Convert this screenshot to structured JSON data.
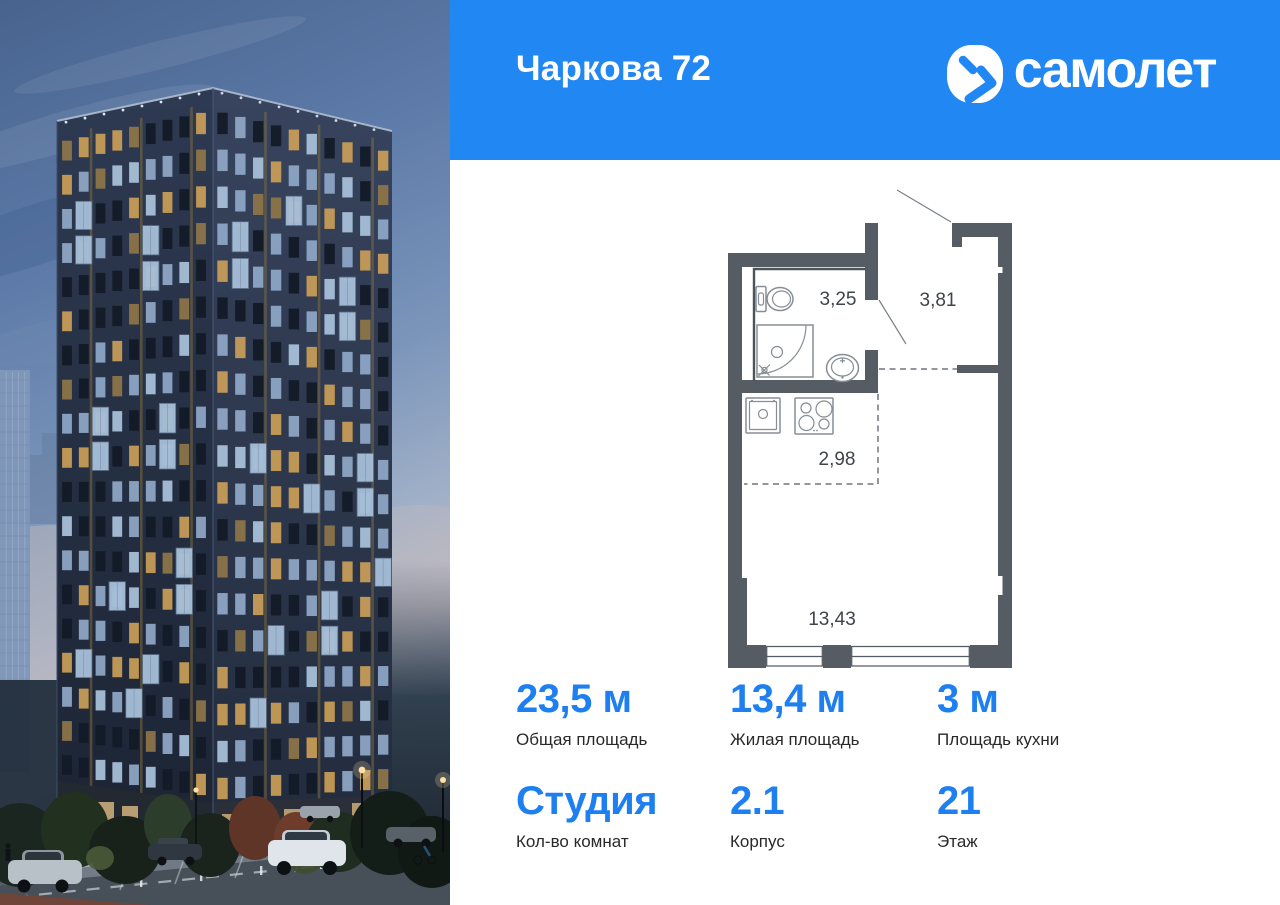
{
  "header": {
    "project_title": "Чаркова 72",
    "brand_name": "самолет"
  },
  "floor_plan": {
    "bathroom_area": "3,25",
    "hallway_area": "3,81",
    "kitchen_area": "2,98",
    "living_area": "13,43"
  },
  "stats": {
    "items": [
      {
        "value": "23,5 м",
        "label": "Общая площадь"
      },
      {
        "value": "13,4 м",
        "label": "Жилая площадь"
      },
      {
        "value": "3 м",
        "label": "Площадь кухни"
      },
      {
        "value": "Студия",
        "label": "Кол-во комнат"
      },
      {
        "value": "2.1",
        "label": "Корпус"
      },
      {
        "value": "21",
        "label": "Этаж"
      }
    ]
  },
  "colors": {
    "brand_blue": "#2187f3",
    "number_blue": "#1d7ff0",
    "plan_wall_gray": "#565c64",
    "label_dark": "#29292b",
    "panel_white": "#ffffff"
  }
}
